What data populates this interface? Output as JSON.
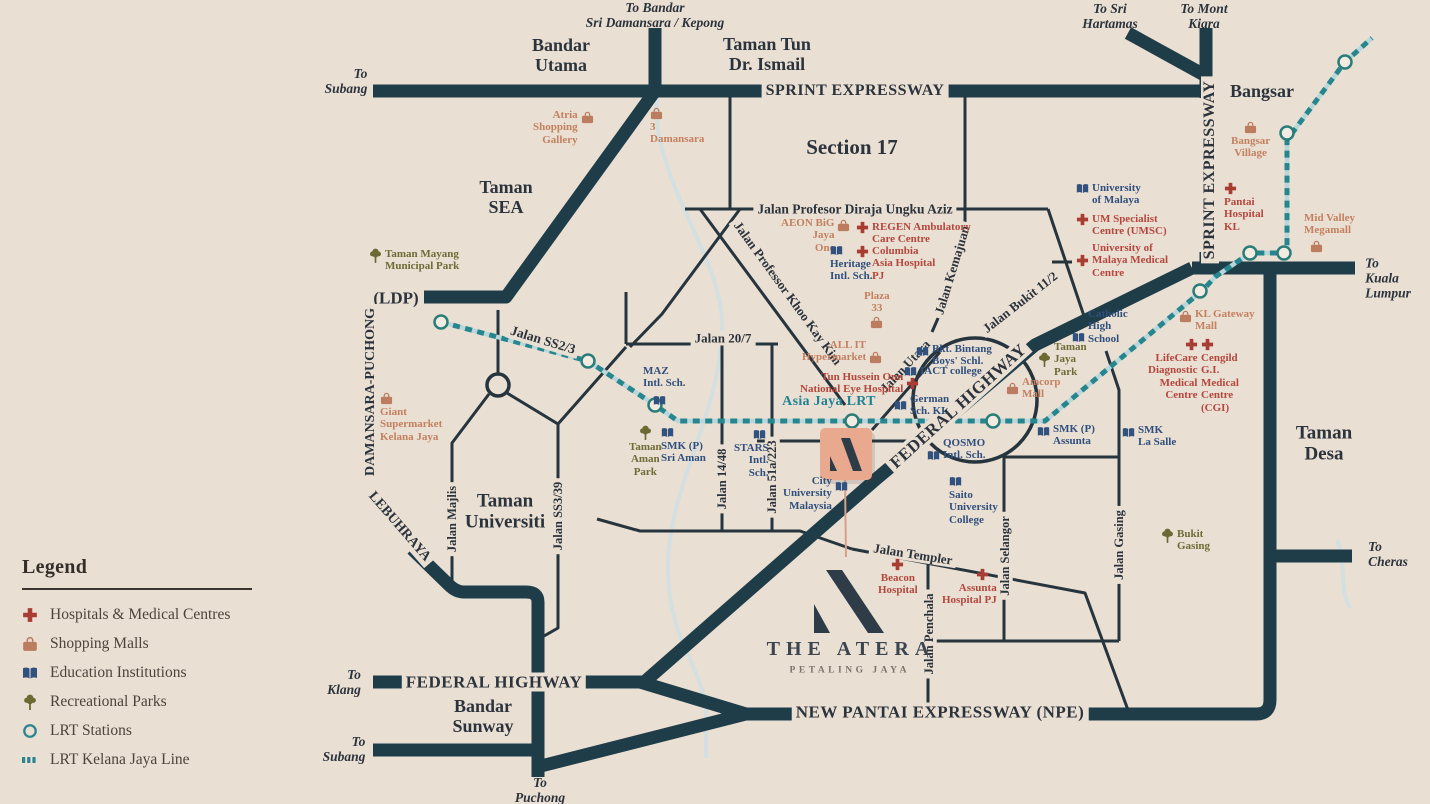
{
  "colors": {
    "background": "#eadfd3",
    "road_major": "#1f3c49",
    "road_minor": "#26343e",
    "hospital": "#a93c33",
    "mall": "#bc7c5f",
    "education": "#31527f",
    "park": "#6c6a33",
    "lrt": "#27858e",
    "label": "#2b333c",
    "atera_marker": "#e9a98f"
  },
  "legend": {
    "title": "Legend",
    "items": [
      {
        "label": "Hospitals & Medical Centres",
        "icon": "hospital-icon"
      },
      {
        "label": "Shopping Malls",
        "icon": "shopping-mall-icon"
      },
      {
        "label": "Education Institutions",
        "icon": "education-icon"
      },
      {
        "label": "Recreational Parks",
        "icon": "park-icon"
      },
      {
        "label": "LRT Stations",
        "icon": "lrt-station-icon"
      },
      {
        "label": "LRT Kelana Jaya Line",
        "icon": "lrt-line-icon"
      }
    ]
  },
  "logo": {
    "name": "THE ATERA",
    "tagline": "PETALING JAYA"
  },
  "map": {
    "areas": {
      "bandar_utama": "Bandar\nUtama",
      "ttdi": "Taman Tun\nDr. Ismail",
      "section17": "Section 17",
      "taman_sea": "Taman\nSEA",
      "bangsar": "Bangsar",
      "taman_desa": "Taman\nDesa",
      "taman_universiti": "Taman\nUniversiti",
      "bandar_sunway": "Bandar\nSunway",
      "ldp": "(LDP)"
    },
    "directions": {
      "kepong": "To Bandar\nSri Damansara / Kepong",
      "subang_top": "To\nSubang",
      "sri_hartamas": "To Sri\nHartamas",
      "mont_kiara": "To Mont\nKiara",
      "kuala_lumpur": "To\nKuala\nLumpur",
      "cheras": "To\nCheras",
      "klang": "To\nKlang",
      "subang_bottom": "To\nSubang",
      "puchong": "To\nPuchong"
    },
    "roads": {
      "sprint_h": "SPRINT EXPRESSWAY",
      "sprint_v": "SPRINT EXPRESSWAY",
      "ungku_aziz": "Jalan Profesor Diraja Ungku Aziz",
      "khoo_kay_kim": "Jalan Professor Khoo Kay Kim",
      "kemajuan": "Jalan Kemajuan",
      "bukit112": "Jalan Bukit 11/2",
      "jalan207": "Jalan 20/7",
      "ss23": "Jalan SS2/3",
      "majlis": "Jalan Majlis",
      "ss339": "Jalan SS3/39",
      "jalan1448": "Jalan 14/48",
      "jalan51a223": "Jalan 51a/223",
      "utara": "Jalan Utara",
      "federal_diag": "FEDERAL HIGHWAY",
      "federal_bottom": "FEDERAL HIGHWAY",
      "npe": "NEW PANTAI EXPRESSWAY (NPE)",
      "templer": "Jalan Templer",
      "penchala": "Jalan Penchala",
      "selangor": "Jalan Selangor",
      "gasing": "Jalan Gasing",
      "lebuhraya": "LEBUHRAYA",
      "damansara_puchong": "DAMANSARA-PUCHONG"
    },
    "lrt_label": "Asia Jaya LRT",
    "hospitals": [
      {
        "text": "REGEN Ambulatory\nCare Centre"
      },
      {
        "text": "Columbia\nAsia Hospital\nPJ"
      },
      {
        "text": "UM Specialist\nCentre (UMSC)"
      },
      {
        "text": "University of\nMalaya Medical\nCentre"
      },
      {
        "text": "Pantai\nHospital\nKL"
      },
      {
        "text": "Tun Hussein Onn\nNational Eye Hospital"
      },
      {
        "text": "LifeCare\nDiagnostic\nMedical\nCentre"
      },
      {
        "text": "Cengild\nG.I.\nMedical\nCentre\n(CGI)"
      },
      {
        "text": "Beacon\nHospital"
      },
      {
        "text": "Assunta\nHospital PJ"
      }
    ],
    "malls": [
      {
        "text": "Atria\nShopping\nGallery"
      },
      {
        "text": "3\nDamansara"
      },
      {
        "text": "AEON BiG\nJaya\nOne"
      },
      {
        "text": "Plaza\n33"
      },
      {
        "text": "ALL IT\nHypermarket"
      },
      {
        "text": "Amcorp\nMall"
      },
      {
        "text": "Giant\nSupermarket\nKelana Jaya"
      },
      {
        "text": "Bangsar\nVillage"
      },
      {
        "text": "Mid Valley\nMegamall"
      },
      {
        "text": "KL Gateway\nMall"
      }
    ],
    "education": [
      {
        "text": "University\nof Malaya"
      },
      {
        "text": "Heritage\nIntl. Sch."
      },
      {
        "text": "Bkt. Bintang\nBoys' Schl."
      },
      {
        "text": "IACT college"
      },
      {
        "text": "German\nSch. KL"
      },
      {
        "text": "MAZ\nIntl. Sch."
      },
      {
        "text": "SMK (P)\nSri Aman"
      },
      {
        "text": "STARS\nIntl.\nSch."
      },
      {
        "text": "City\nUniversity\nMalaysia"
      },
      {
        "text": "QOSMO\nIntl. Sch."
      },
      {
        "text": "SMK (P)\nAssunta"
      },
      {
        "text": "SMK\nLa Salle"
      },
      {
        "text": "Saito\nUniversity\nCollege"
      },
      {
        "text": "Catholic\nHigh\nSchool"
      }
    ],
    "parks": [
      {
        "text": "Taman Mayang\nMunicipal Park"
      },
      {
        "text": "Taman\nAman\nPark"
      },
      {
        "text": "Taman\nJaya\nPark"
      },
      {
        "text": "Bukit\nGasing"
      }
    ]
  }
}
